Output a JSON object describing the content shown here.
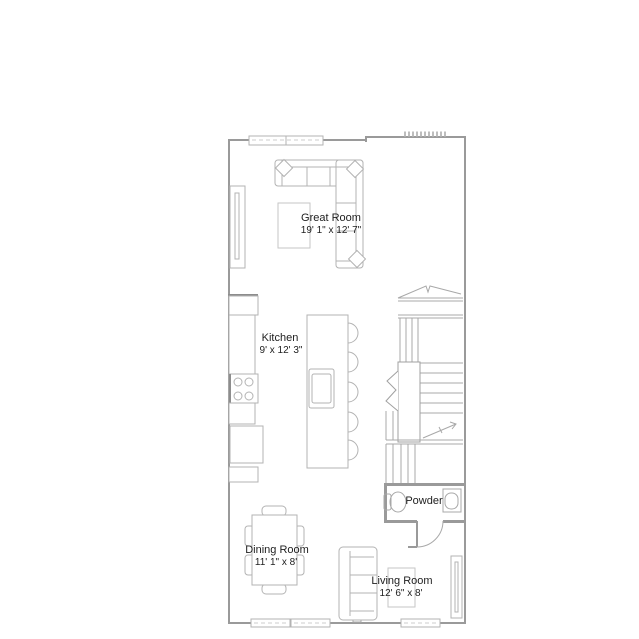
{
  "colors": {
    "background": "#ffffff",
    "wall": "#9a9a9a",
    "furniture_line": "#b3b3b3",
    "stair_line": "#a8a8a8",
    "text": "#1e1e1e"
  },
  "rooms": {
    "great_room": {
      "name": "Great Room",
      "dims": "19' 1\" x 12' 7\""
    },
    "kitchen": {
      "name": "Kitchen",
      "dims": "9' x 12' 3\""
    },
    "powder": {
      "name": "Powder"
    },
    "dining_room": {
      "name": "Dining Room",
      "dims": "11' 1\" x 8'"
    },
    "living_room": {
      "name": "Living Room",
      "dims": "12' 6\" x 8'"
    }
  }
}
